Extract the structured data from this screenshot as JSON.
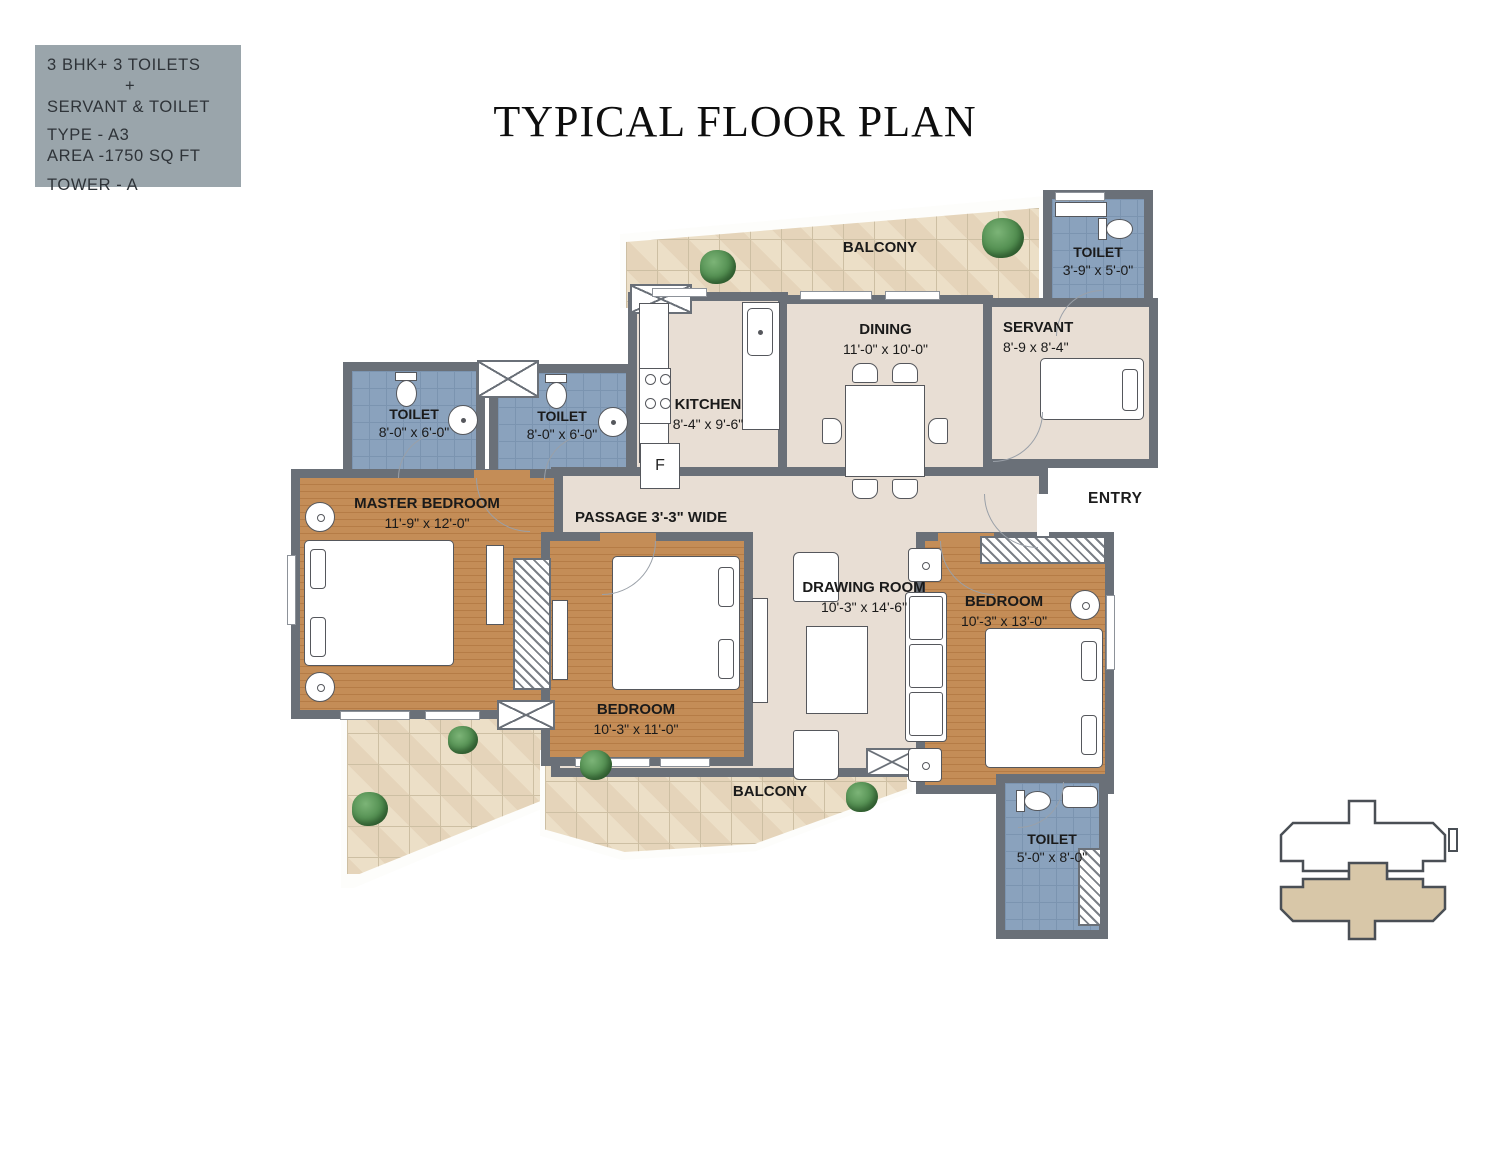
{
  "info_box": {
    "line1": "3 BHK+ 3 TOILETS",
    "line2": "+",
    "line3": "SERVANT & TOILET",
    "line4": "TYPE - A3",
    "line5": "AREA -1750 SQ FT",
    "line6": "TOWER - A"
  },
  "title": "TYPICAL FLOOR PLAN",
  "rooms": {
    "balcony_top": {
      "name": "BALCONY"
    },
    "toilet_top_right": {
      "name": "TOILET",
      "dims": "3'-9\" x 5'-0\""
    },
    "servant": {
      "name": "SERVANT",
      "dims": "8'-9 x 8'-4\""
    },
    "dining": {
      "name": "DINING",
      "dims": "11'-0\" x 10'-0\""
    },
    "kitchen": {
      "name": "KITCHEN",
      "dims": "8'-4\" x 9'-6\"",
      "fridge_label": "F"
    },
    "toilet_left_1": {
      "name": "TOILET",
      "dims": "8'-0\" x 6'-0\""
    },
    "toilet_left_2": {
      "name": "TOILET",
      "dims": "8'-0\" x 6'-0\""
    },
    "master_bedroom": {
      "name": "MASTER BEDROOM",
      "dims": "11'-9\" x 12'-0\""
    },
    "passage": {
      "name": "PASSAGE 3'-3\" WIDE"
    },
    "entry": {
      "name": "ENTRY"
    },
    "drawing_room": {
      "name": "DRAWING ROOM",
      "dims": "10'-3\" x 14'-6\""
    },
    "bedroom_center": {
      "name": "BEDROOM",
      "dims": "10'-3\" x 11'-0\""
    },
    "bedroom_right": {
      "name": "BEDROOM",
      "dims": "10'-3\" x 13'-0\""
    },
    "balcony_bottom": {
      "name": "BALCONY"
    },
    "toilet_bottom": {
      "name": "TOILET",
      "dims": "5'-0\" x 8'-0\""
    }
  },
  "colors": {
    "wall": "#6a7078",
    "floor_beige": "#e8ded4",
    "floor_wood": "#c28b55",
    "toilet_tile": "#8aa2bd",
    "balcony_tile": "#ecdfc7",
    "info_box_bg": "#9aa5ab",
    "keyplan_fill": "#d8c7a8"
  }
}
